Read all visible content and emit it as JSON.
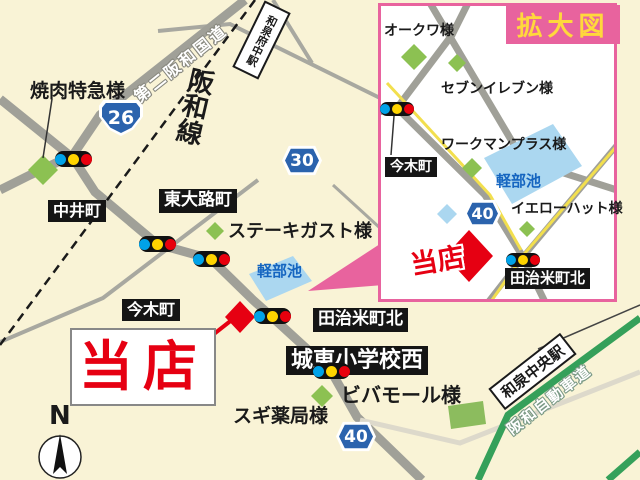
{
  "main_map": {
    "yakiniku_label": "焼肉特急様",
    "road_name_dai2hanwa": "第二阪和国道",
    "rail_line_label": "阪和線",
    "station_izumifuchu": "和泉府中駅",
    "station_izumichuo": "和泉中央駅",
    "route26": "26",
    "route30": "30",
    "route40": "40",
    "nakaicho": "中井町",
    "higashiojicho": "東大路町",
    "imakicho": "今木町",
    "steak_gusto": "ステーキガスト様",
    "pond": "軽部池",
    "tajimecho_kita": "田治米町北",
    "joto_elementary_west": "城東小学校西",
    "viva_mall": "ビバモール様",
    "sugi_pharmacy": "スギ薬局様",
    "expressway_name": "阪和自動車道",
    "store_label": "当店",
    "compass_n": "N"
  },
  "inset": {
    "title": "拡大図",
    "okuwa": "オークワ様",
    "seven_eleven": "セブンイレブン様",
    "workman_plus": "ワークマンプラス様",
    "imakicho": "今木町",
    "pond": "軽部池",
    "route40": "40",
    "yellow_hat": "イエローハット様",
    "store_label": "当店",
    "tajimecho_kita": "田治米町北"
  },
  "colors": {
    "background_cream": "#f9f3d6",
    "accent_pink": "#e8639e",
    "store_red": "#e60012",
    "route_sign_blue": "#2b63ad",
    "expressway_green": "#35a05a",
    "pond_blue": "#abd7f0",
    "landmark_green": "#8cc152",
    "road_gray": "#a0a098",
    "signal_blue": "#00a2e8",
    "signal_yellow": "#ffd400",
    "signal_red": "#e8000d"
  }
}
